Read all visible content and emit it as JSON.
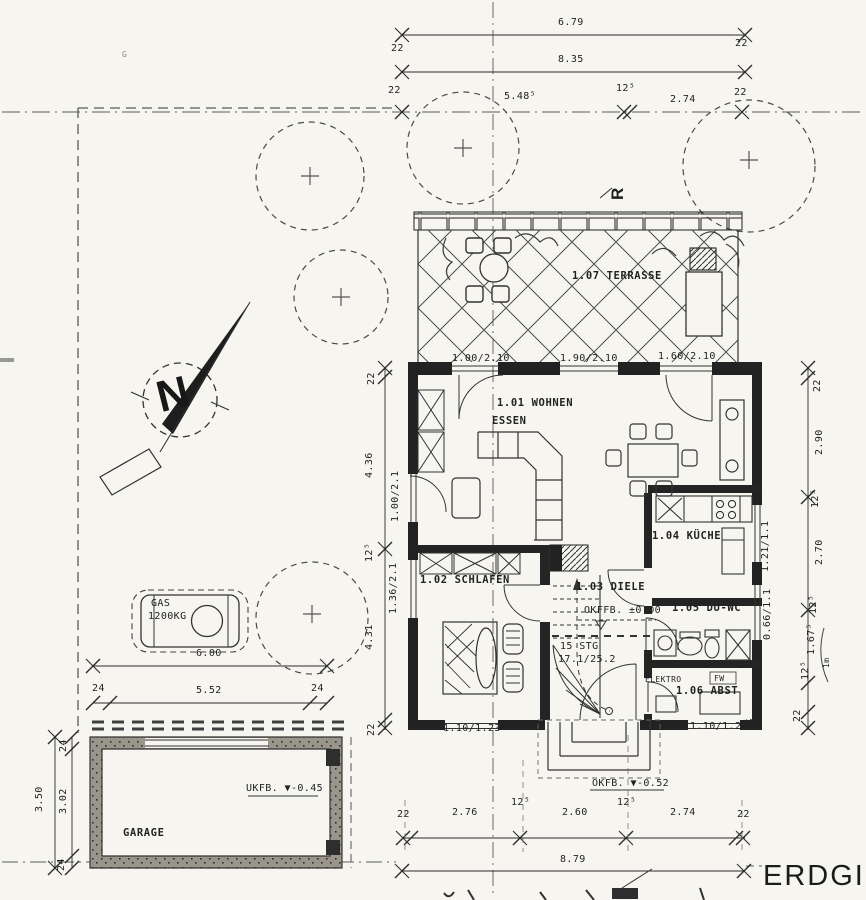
{
  "sheet": {
    "title": "ERDGI"
  },
  "rooms": {
    "terrasse": "1.07 TERRASSE",
    "wohnen": "1.01 WOHNEN",
    "essen": "ESSEN",
    "kueche": "1.04 KÜCHE",
    "schlafen": "1.02 SCHLAFEN",
    "diele": "1.03 DIELE",
    "duwc": "1.05 DU-WC",
    "abst": "1.06 ABST",
    "garage": "GARAGE"
  },
  "levels": {
    "eg": "OKFFB. ±0.00",
    "entry": "OKFB. ▼-0.52",
    "garage": "UKFB. ▼-0.45"
  },
  "equipment": {
    "gas_line1": "GAS",
    "gas_line2": "1200KG",
    "elektro": "ELEKTRO",
    "fw": "FW"
  },
  "stairs": {
    "line1": "15 STG",
    "line2": "17.1/25.2"
  },
  "north_letter": "N",
  "marks": {
    "r": "R",
    "rr": "RR",
    "pr": "*PR",
    "g": "G",
    "scale_note": "1m"
  },
  "window_labels": {
    "terr1": "1.00/2.10",
    "terr2": "1.90/2.10",
    "terr3": "1.60/2.10",
    "bottom_left": "1.10/1.23",
    "bottom_right": "1.10/1.23",
    "right_upper": "1.21/1.1",
    "right_lower": "0.66/1.1",
    "left_upper": "1.00/2.1",
    "left_lower": "1.36/2.1"
  },
  "dims": {
    "top_total": "6.79",
    "top_second": "8.35",
    "top_seg1": "5.48⁵",
    "top_seg2": "12⁵",
    "top_seg3": "2.74",
    "top_22_l1": "22",
    "top_22_l2": "22",
    "top_22_r1": "22",
    "top_22_r2": "22",
    "left_chain": [
      "22",
      "4.36",
      "12⁵",
      "4.31",
      "22"
    ],
    "right_chain": [
      "22",
      "2.90",
      "12⁵",
      "2.70",
      "12⁵",
      "1.67⁵",
      "12⁵",
      "22"
    ],
    "bottom_chain": [
      "22",
      "2.76",
      "12⁵",
      "2.60",
      "12⁵",
      "2.74",
      "22"
    ],
    "bottom_total": "8.79",
    "garage_outer": "3.50",
    "garage_chain": [
      "24",
      "3.02",
      "24"
    ],
    "gas_total": "6.00",
    "gas_inner": "5.52",
    "gas_24_l": "24",
    "gas_24_r": "24"
  }
}
